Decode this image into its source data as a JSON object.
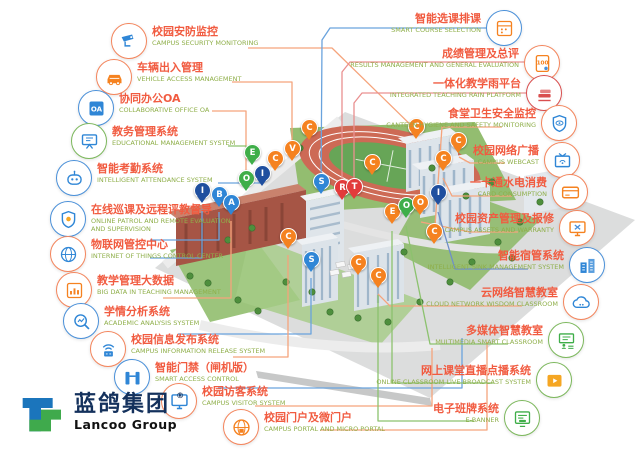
{
  "brand": {
    "name_cn": "蓝鸽集团",
    "name_en": "Lancoo Group",
    "registered": "®",
    "logo_blue": "#1b75bc",
    "logo_green": "#3faa4c"
  },
  "palette": {
    "cn_text": "#f15b40",
    "en_text": "#8faf4a",
    "pin_orange": "#f58220",
    "pin_green": "#3fae49",
    "pin_navy": "#1f4f9f",
    "pin_blue": "#2f86d6",
    "pin_red": "#e23b3b"
  },
  "left_labels": [
    {
      "cn": "校园安防监控",
      "en": "CAMPUS SECURITY MONITORING",
      "icon": "cctv",
      "circle": "#f4855c",
      "glyph": "#2f86d6",
      "pos": [
        111,
        23
      ]
    },
    {
      "cn": "车辆出入管理",
      "en": "VEHICLE ACCESS MANAGEMENT",
      "icon": "car",
      "circle": "#f4855c",
      "glyph": "#f58220",
      "pos": [
        96,
        59
      ]
    },
    {
      "cn": "协同办公OA",
      "en": "COLLABORATIVE OFFICE OA",
      "icon": "oa",
      "circle": "#4a90d9",
      "glyph": "#2f86d6",
      "pos": [
        78,
        90
      ]
    },
    {
      "cn": "教务管理系统",
      "en": "EDUCATIONAL MANAGEMENT SYSTEM",
      "icon": "board",
      "circle": "#7cb85c",
      "glyph": "#2f86d6",
      "pos": [
        71,
        123
      ]
    },
    {
      "cn": "智能考勤系统",
      "en": "INTELLIGENT ATTENDANCE SYSTEM",
      "icon": "robot",
      "circle": "#4a90d9",
      "glyph": "#2f86d6",
      "pos": [
        56,
        160
      ]
    },
    {
      "cn": "在线巡课及远程评教督导",
      "en": "ONLINE PATROL AND REMOTE EVALUATION AND SUPERVISION",
      "icon": "shield",
      "circle": "#4a90d9",
      "glyph": "#2f86d6",
      "pos": [
        50,
        201
      ]
    },
    {
      "cn": "物联网管控中心",
      "en": "INTERNET OF THINGS CONTROL CENTER",
      "icon": "globe",
      "circle": "#f4855c",
      "glyph": "#2f86d6",
      "pos": [
        50,
        236
      ]
    },
    {
      "cn": "教学管理大数据",
      "en": "BIG DATA IN TEACHING MANAGEMENT",
      "icon": "chart",
      "circle": "#f4855c",
      "glyph": "#f58220",
      "pos": [
        56,
        272
      ]
    },
    {
      "cn": "学情分析系统",
      "en": "ACADEMIC ANALYSIS SYSTEM",
      "icon": "magnifier",
      "circle": "#4a90d9",
      "glyph": "#2f86d6",
      "pos": [
        63,
        303
      ]
    },
    {
      "cn": "校园信息发布系统",
      "en": "CAMPUS INFORMATION RELEASE SYSTEM",
      "icon": "wifi",
      "circle": "#f4855c",
      "glyph": "#2f86d6",
      "pos": [
        90,
        331
      ]
    },
    {
      "cn": "智能门禁（闸机版）",
      "en": "SMART ACCESS CONTROL",
      "icon": "gate",
      "circle": "#4a90d9",
      "glyph": "#2f86d6",
      "pos": [
        114,
        359
      ]
    },
    {
      "cn": "校园访客系统",
      "en": "CAMPUS VISITOR SYSTEM",
      "icon": "monitor",
      "circle": "#f4855c",
      "glyph": "#2f86d6",
      "pos": [
        161,
        383
      ]
    },
    {
      "cn": "校园门户及微门户",
      "en": "CAMPUS PORTAL AND MICRO PORTAL",
      "icon": "portal",
      "circle": "#f4855c",
      "glyph": "#f58220",
      "pos": [
        223,
        409
      ]
    }
  ],
  "right_labels": [
    {
      "cn": "智能选课排课",
      "en": "SMART COURSE SELECTION",
      "icon": "schedule",
      "circle": "#4a90d9",
      "glyph": "#f58220",
      "pos": [
        118,
        10
      ]
    },
    {
      "cn": "成绩管理及总评",
      "en": "RESULTS MANAGEMENT AND GENERAL EVALUATION",
      "icon": "score",
      "circle": "#f4855c",
      "glyph": "#f58220",
      "pos": [
        80,
        45
      ]
    },
    {
      "cn": "一体化教学雨平台",
      "en": "INTEGRATED TEACHING RAIN PLATFORM",
      "icon": "books",
      "circle": "#d94f4f",
      "glyph": "#d94f4f",
      "pos": [
        78,
        75
      ]
    },
    {
      "cn": "食堂卫生安全监控",
      "en": "CANTEEN HYGIENE AND SAFETY MONITORING",
      "icon": "shieldeye",
      "circle": "#f4855c",
      "glyph": "#2f86d6",
      "pos": [
        63,
        105
      ]
    },
    {
      "cn": "校园网络广播",
      "en": "CAMPUS WEBCAST",
      "icon": "tv",
      "circle": "#f4855c",
      "glyph": "#2f86d6",
      "pos": [
        60,
        142
      ]
    },
    {
      "cn": "一卡通水电消费",
      "en": "CARD CONSUMPTION",
      "icon": "card",
      "circle": "#f4855c",
      "glyph": "#f58220",
      "pos": [
        52,
        174
      ]
    },
    {
      "cn": "校园资产管理及报修",
      "en": "CAMPUS ASSETS AND WARRANTY",
      "icon": "repair",
      "circle": "#f4855c",
      "glyph": "#f58220",
      "pos": [
        45,
        210
      ]
    },
    {
      "cn": "智能宿管系统",
      "en": "INTELLIGENT SINK MANAGEMENT SYSTEM",
      "icon": "buildings",
      "circle": "#4a90d9",
      "glyph": "#2f86d6",
      "pos": [
        35,
        247
      ]
    },
    {
      "cn": "云网络智慧教室",
      "en": "CLOUD NETWORK WISDOM CLASSROOM",
      "icon": "cloud",
      "circle": "#f4855c",
      "glyph": "#2f86d6",
      "pos": [
        41,
        284
      ]
    },
    {
      "cn": "多媒体智慧教室",
      "en": "MULTIMEDIA SMART CLASSROOM",
      "icon": "classroom",
      "circle": "#7cb85c",
      "glyph": "#3fae49",
      "pos": [
        56,
        322
      ]
    },
    {
      "cn": "网上课堂直播点播系统",
      "en": "ONLINE CLASSROOM LIVE BROADCAST SYSTEM",
      "icon": "video",
      "circle": "#7cb85c",
      "glyph": "#f5a623",
      "pos": [
        68,
        362
      ]
    },
    {
      "cn": "电子班牌系统",
      "en": "E-BANNER",
      "icon": "banner",
      "circle": "#7cb85c",
      "glyph": "#3fae49",
      "pos": [
        100,
        400
      ]
    }
  ],
  "map": {
    "pins": [
      {
        "letter": "E",
        "color": "green",
        "x": 252,
        "y": 167
      },
      {
        "letter": "C",
        "color": "orange",
        "x": 275,
        "y": 173
      },
      {
        "letter": "V",
        "color": "orange",
        "x": 292,
        "y": 163
      },
      {
        "letter": "C",
        "color": "orange",
        "x": 309,
        "y": 142
      },
      {
        "letter": "O",
        "color": "green",
        "x": 246,
        "y": 193
      },
      {
        "letter": "I",
        "color": "navy",
        "x": 262,
        "y": 188
      },
      {
        "letter": "I",
        "color": "navy",
        "x": 202,
        "y": 205
      },
      {
        "letter": "B",
        "color": "blue",
        "x": 219,
        "y": 209
      },
      {
        "letter": "A",
        "color": "blue",
        "x": 231,
        "y": 217
      },
      {
        "letter": "S",
        "color": "blue",
        "x": 321,
        "y": 196
      },
      {
        "letter": "R",
        "color": "red",
        "x": 342,
        "y": 202
      },
      {
        "letter": "T",
        "color": "red",
        "x": 354,
        "y": 201
      },
      {
        "letter": "C",
        "color": "orange",
        "x": 372,
        "y": 177
      },
      {
        "letter": "C",
        "color": "orange",
        "x": 416,
        "y": 141
      },
      {
        "letter": "C",
        "color": "orange",
        "x": 458,
        "y": 155
      },
      {
        "letter": "C",
        "color": "orange",
        "x": 443,
        "y": 173
      },
      {
        "letter": "I",
        "color": "navy",
        "x": 438,
        "y": 207
      },
      {
        "letter": "E",
        "color": "orange",
        "x": 392,
        "y": 226
      },
      {
        "letter": "O",
        "color": "green",
        "x": 406,
        "y": 220
      },
      {
        "letter": "O",
        "color": "orange",
        "x": 420,
        "y": 217
      },
      {
        "letter": "C",
        "color": "orange",
        "x": 288,
        "y": 251
      },
      {
        "letter": "S",
        "color": "blue",
        "x": 311,
        "y": 274
      },
      {
        "letter": "C",
        "color": "orange",
        "x": 358,
        "y": 277
      },
      {
        "letter": "C",
        "color": "orange",
        "x": 378,
        "y": 290
      },
      {
        "letter": "C",
        "color": "orange",
        "x": 434,
        "y": 246
      }
    ]
  },
  "connectors": [
    {
      "color": "#f5a47c",
      "points": "248,48 332,48 420,134"
    },
    {
      "color": "#f5a47c",
      "points": "232,82 292,82 292,157"
    },
    {
      "color": "#f5a47c",
      "points": "212,111 246,111 246,187"
    },
    {
      "color": "#8cc26e",
      "points": "228,146 246,146 252,161"
    },
    {
      "color": "#6aa3dd",
      "points": "218,183 250,183 261,183"
    },
    {
      "color": "#6aa3dd",
      "points": "150,240 219,240 219,212"
    },
    {
      "color": "#6aa3dd",
      "points": "150,258 202,258 202,209"
    },
    {
      "color": "#f5a47c",
      "points": "163,298 231,298 231,221"
    },
    {
      "color": "#6aa3dd",
      "points": "178,334 311,334 311,278"
    },
    {
      "color": "#f5a47c",
      "points": "233,357 288,357 288,255"
    },
    {
      "color": "#6aa3dd",
      "points": "218,388 462,388 462,338"
    },
    {
      "color": "#f5a47c",
      "points": "255,406 432,406 432,348"
    },
    {
      "color": "#f5a47c",
      "points": "320,430 487,430 487,342"
    },
    {
      "color": "#6aa3dd",
      "points": "488,28 330,28 322,40 321,190"
    },
    {
      "color": "#e99090",
      "points": "525,62 350,62 342,72 342,196"
    },
    {
      "color": "#e99090",
      "points": "527,93 362,93 354,103 354,195"
    },
    {
      "color": "#f5a47c",
      "points": "502,127 442,127 434,240"
    },
    {
      "color": "#f5a47c",
      "points": "505,163 470,163 459,157"
    },
    {
      "color": "#f5a47c",
      "points": "512,196 452,196 443,178"
    },
    {
      "color": "#f5a47c",
      "points": "518,232 470,232 421,222"
    },
    {
      "color": "#6e8fc9",
      "points": "528,269 455,269 438,212"
    },
    {
      "color": "#f5a47c",
      "points": "522,306 390,306 378,294"
    },
    {
      "color": "#8cc26e",
      "points": "508,344 430,344 406,226"
    },
    {
      "color": "#8cc26e",
      "points": "494,383 392,383 392,231"
    },
    {
      "color": "#8cc26e",
      "points": "474,421 378,421 378,295"
    }
  ]
}
